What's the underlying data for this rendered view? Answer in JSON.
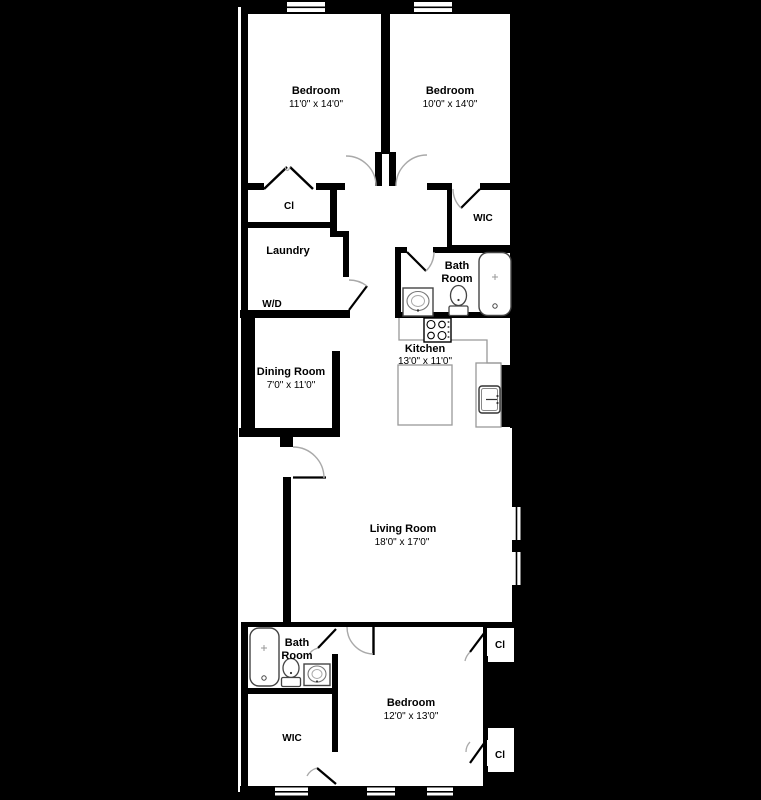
{
  "title": "Apartment floor plan",
  "colors": {
    "background": "#000000",
    "floor": "#ffffff",
    "wall": "#000000",
    "door_arc": "#a9a9a9",
    "fixture_outline": "#444444",
    "counter_outline": "#999999",
    "label_text": "#000000"
  },
  "rooms": {
    "bedroom_top_left": {
      "name": "Bedroom",
      "dims": "11'0\" x 14'0\""
    },
    "bedroom_top_right": {
      "name": "Bedroom",
      "dims": "10'0\" x 14'0\""
    },
    "closet_top": {
      "name": "Cl"
    },
    "laundry": {
      "name": "Laundry",
      "appliance": "W/D"
    },
    "wic_top": {
      "name": "WIC"
    },
    "bath_top": {
      "line1": "Bath",
      "line2": "Room"
    },
    "kitchen": {
      "name": "Kitchen",
      "dims": "13'0\" x 11'0\""
    },
    "dining": {
      "name": "Dining Room",
      "dims": "7'0\" x 11'0\""
    },
    "living": {
      "name": "Living Room",
      "dims": "18'0\" x 17'0\""
    },
    "bath_bottom": {
      "line1": "Bath",
      "line2": "Room"
    },
    "wic_bottom": {
      "name": "WIC"
    },
    "bedroom_bottom": {
      "name": "Bedroom",
      "dims": "12'0\" x 13'0\""
    },
    "closet_br_top": {
      "name": "Cl"
    },
    "closet_br_bottom": {
      "name": "Cl"
    }
  }
}
